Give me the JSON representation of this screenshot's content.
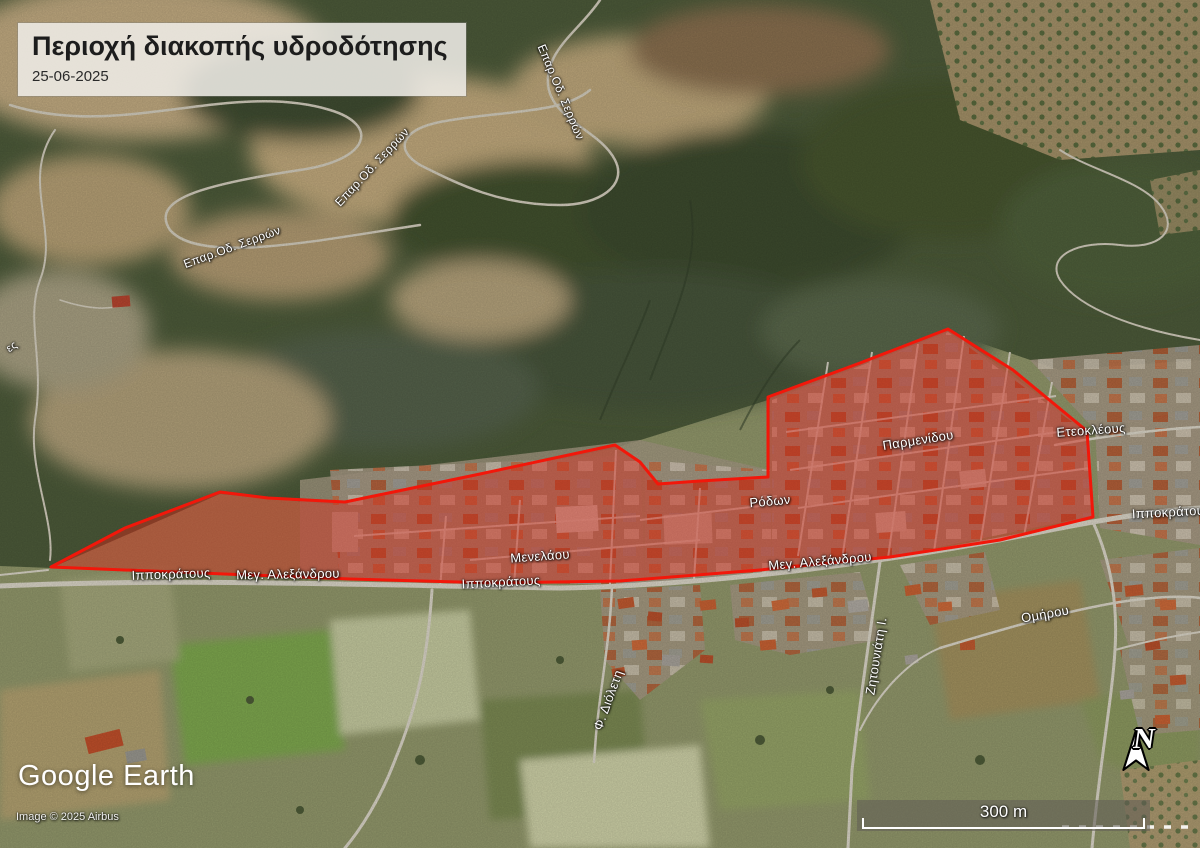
{
  "title_box": {
    "title": "Περιοχή διακοπής υδροδότησης",
    "date": "25-06-2025"
  },
  "branding": {
    "logo": "Google Earth",
    "attribution": "Image © 2025 Airbus"
  },
  "scale_bar": {
    "label": "300 m"
  },
  "north_indicator": {
    "label": "N"
  },
  "overlay": {
    "label": "water-supply-interruption-zone",
    "fill": "#d62718",
    "fill_opacity": 0.46,
    "stroke": "#f2170a",
    "stroke_width": 3
  },
  "street_labels": [
    {
      "text": "Ιπποκράτους",
      "x": 171,
      "y": 574,
      "rot": -2
    },
    {
      "text": "Μεγ. Αλεξάνδρου",
      "x": 288,
      "y": 574,
      "rot": -1
    },
    {
      "text": "Ιπποκράτους",
      "x": 501,
      "y": 582,
      "rot": -3
    },
    {
      "text": "Μενελάου",
      "x": 540,
      "y": 556,
      "rot": -4
    },
    {
      "text": "Ρόδων",
      "x": 770,
      "y": 501,
      "rot": -5
    },
    {
      "text": "Παρμενίδου",
      "x": 918,
      "y": 440,
      "rot": -9
    },
    {
      "text": "Μεγ. Αλεξάνδρου",
      "x": 820,
      "y": 561,
      "rot": -5
    },
    {
      "text": "Ομήρου",
      "x": 1045,
      "y": 614,
      "rot": -10
    },
    {
      "text": "Ζητουνιάτη Ι.",
      "x": 876,
      "y": 656,
      "rot": -81
    },
    {
      "text": "Φ. Διόλετη",
      "x": 608,
      "y": 700,
      "rot": -70
    },
    {
      "text": "Επαρ.Οδ. Σερρών",
      "x": 232,
      "y": 247,
      "rot": -20,
      "size": 12
    },
    {
      "text": "Επαρ.Οδ. Σερρών",
      "x": 372,
      "y": 167,
      "rot": -47,
      "size": 12
    },
    {
      "text": "Επαρ.Οδ. Σερρών",
      "x": 561,
      "y": 92,
      "rot": 67,
      "size": 12
    },
    {
      "text": "Ετεοκλέους",
      "x": 1091,
      "y": 430,
      "rot": -4
    },
    {
      "text": "Ιπποκράτου",
      "x": 1168,
      "y": 512,
      "rot": -3
    },
    {
      "text": "ες",
      "x": 12,
      "y": 347,
      "rot": -35,
      "size": 11
    }
  ]
}
